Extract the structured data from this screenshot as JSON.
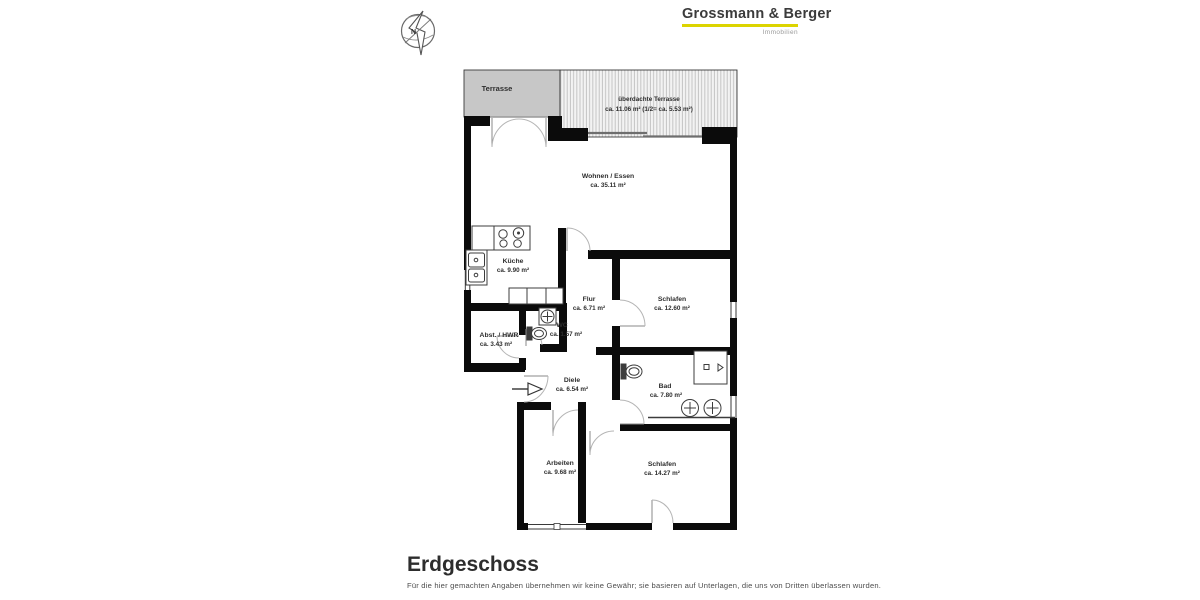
{
  "brand": {
    "name": "Grossmann & Berger",
    "tagline": "Immobilien",
    "underline_color": "#dcd400"
  },
  "compass": {
    "label": "N"
  },
  "floor": {
    "title": "Erdgeschoss",
    "disclaimer": "Für die hier gemachten Angaben übernehmen wir keine Gewähr; sie basieren auf Unterlagen, die uns von Dritten überlassen wurden."
  },
  "rooms": [
    {
      "id": "terrasse",
      "name": "Terrasse",
      "area": ""
    },
    {
      "id": "ueberdachte-terrasse",
      "name": "überdachte Terrasse",
      "area": "ca. 11.06 m² (1/2= ca. 5.53 m²)"
    },
    {
      "id": "wohnen-essen",
      "name": "Wohnen / Essen",
      "area": "ca. 35.11 m²"
    },
    {
      "id": "kueche",
      "name": "Küche",
      "area": "ca. 9.90 m²"
    },
    {
      "id": "flur",
      "name": "Flur",
      "area": "ca. 6.71 m²"
    },
    {
      "id": "schlafen-1",
      "name": "Schlafen",
      "area": "ca. 12.60 m²"
    },
    {
      "id": "wc",
      "name": "WC",
      "area": "ca. 1.57 m²"
    },
    {
      "id": "abstellraum-hwr",
      "name": "Abst. / HWR",
      "area": "ca. 3.43 m²"
    },
    {
      "id": "diele",
      "name": "Diele",
      "area": "ca. 6.54 m²"
    },
    {
      "id": "bad",
      "name": "Bad",
      "area": "ca. 7.80 m²"
    },
    {
      "id": "arbeiten",
      "name": "Arbeiten",
      "area": "ca. 9.68 m²"
    },
    {
      "id": "schlafen-2",
      "name": "Schlafen",
      "area": "ca. 14.27 m²"
    }
  ],
  "icons": [
    "compass-icon",
    "stove-icon",
    "kitchen-sink-icon",
    "washing-machine-icon",
    "toilet-icon",
    "shower-icon",
    "washbasin-icon",
    "entrance-arrow-icon"
  ],
  "colors": {
    "wall": "#0b0b0b",
    "terrace_fill": "#c7c7c7",
    "hatch_line": "#bfbfbf",
    "label_text": "#2e2e2e",
    "accent_underline": "#dcd400"
  }
}
